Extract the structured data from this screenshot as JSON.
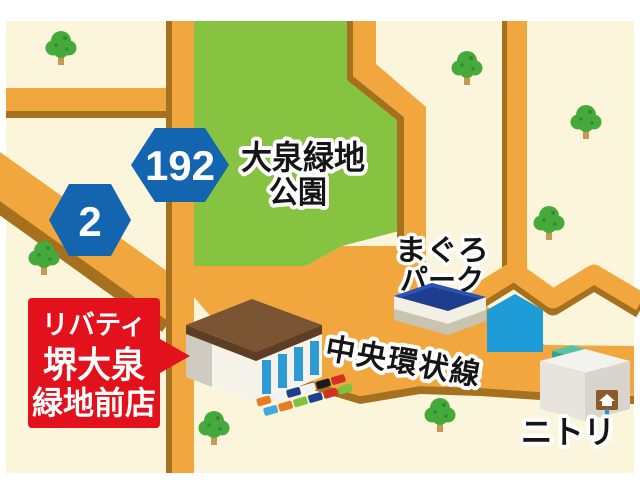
{
  "map": {
    "park": {
      "line1": "大泉緑地",
      "line2": "公園"
    },
    "route_signs": [
      {
        "number": "192"
      },
      {
        "number": "2"
      }
    ],
    "poi": {
      "maguro": {
        "line1": "まぐろ",
        "line2": "パーク"
      },
      "road_name": "中央環状線",
      "nitori": "ニトリ"
    },
    "store_sign": {
      "line1": "リバティ",
      "line2": "堺大泉",
      "line3": "緑地前店"
    }
  },
  "colors": {
    "background_cream": "#FBF5DB",
    "frame_white": "#FFFFFF",
    "road": "#F2A73E",
    "road_shadow": "#A6711E",
    "park_green": "#85C341",
    "hex_blue": "#1465AF",
    "sign_red": "#E3111B",
    "pentagon_blue": "#1E9CD8",
    "maguro_roof_navy": "#1E3D8F",
    "store_roof_brown": "#7A5433",
    "stripe_blue": "#2E9BD6",
    "teal_cube": "#2FA38B",
    "tree_green": "#46A93C",
    "text_black": "#151515"
  },
  "cars": {
    "row1": [
      "#e87b22",
      "#f2f2f2",
      "#1d3f8f",
      "#f2f2f2",
      "#1a1a1a",
      "#d62f23"
    ],
    "row2": [
      "#3fa9dc",
      "#e87b22",
      "#7ec242",
      "#1d3f8f",
      "#d62f23",
      "#7ec242"
    ]
  }
}
